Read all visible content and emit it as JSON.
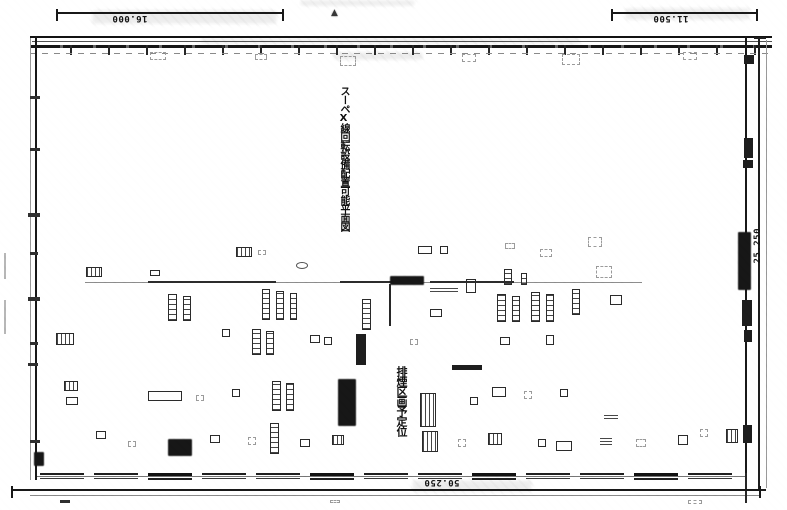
{
  "dimension_labels": {
    "top_left": "16.000",
    "top_right": "11.500",
    "bottom": "50.250",
    "right": "25.250"
  },
  "markers": {
    "section_triangle": "▲"
  },
  "vertical_texts": {
    "main": "スーペX線回転設備配置可能平面図",
    "lower": "排煙区画予定位"
  },
  "colors": {
    "paper": "#ffffff",
    "ink": "#1c1c1c",
    "ink_mid": "#444444",
    "ink_faint": "#999999",
    "smudge": "#d6d6d6"
  },
  "symbols": [
    {
      "x": 150,
      "y": 52,
      "w": 16,
      "h": 8,
      "k": "faint"
    },
    {
      "x": 255,
      "y": 54,
      "w": 12,
      "h": 6,
      "k": "faint"
    },
    {
      "x": 340,
      "y": 56,
      "w": 16,
      "h": 10,
      "k": "faint"
    },
    {
      "x": 462,
      "y": 54,
      "w": 14,
      "h": 8,
      "k": "faint"
    },
    {
      "x": 562,
      "y": 54,
      "w": 18,
      "h": 11,
      "k": "faint"
    },
    {
      "x": 683,
      "y": 52,
      "w": 14,
      "h": 8,
      "k": "faint"
    },
    {
      "x": 744,
      "y": 55,
      "w": 10,
      "h": 9,
      "k": "dark"
    },
    {
      "x": 30,
      "y": 96,
      "w": 10,
      "h": 3,
      "k": "tick"
    },
    {
      "x": 30,
      "y": 148,
      "w": 10,
      "h": 3,
      "k": "tick"
    },
    {
      "x": 28,
      "y": 213,
      "w": 12,
      "h": 4,
      "k": "tick"
    },
    {
      "x": 30,
      "y": 252,
      "w": 8,
      "h": 3,
      "k": "tick"
    },
    {
      "x": 28,
      "y": 297,
      "w": 12,
      "h": 4,
      "k": "tick"
    },
    {
      "x": 30,
      "y": 342,
      "w": 8,
      "h": 3,
      "k": "tick"
    },
    {
      "x": 28,
      "y": 363,
      "w": 10,
      "h": 3,
      "k": "tick"
    },
    {
      "x": 30,
      "y": 440,
      "w": 10,
      "h": 3,
      "k": "tick"
    },
    {
      "x": 34,
      "y": 452,
      "w": 10,
      "h": 14,
      "k": "dense"
    },
    {
      "x": 4,
      "y": 253,
      "w": 2,
      "h": 26,
      "k": "vfaint"
    },
    {
      "x": 4,
      "y": 300,
      "w": 2,
      "h": 34,
      "k": "vfaint"
    },
    {
      "x": 744,
      "y": 138,
      "w": 9,
      "h": 20,
      "k": "dark"
    },
    {
      "x": 743,
      "y": 160,
      "w": 10,
      "h": 8,
      "k": "dark"
    },
    {
      "x": 738,
      "y": 232,
      "w": 13,
      "h": 58,
      "k": "dense"
    },
    {
      "x": 742,
      "y": 300,
      "w": 10,
      "h": 26,
      "k": "dark"
    },
    {
      "x": 744,
      "y": 330,
      "w": 8,
      "h": 12,
      "k": "dark"
    },
    {
      "x": 743,
      "y": 425,
      "w": 9,
      "h": 18,
      "k": "dark"
    },
    {
      "x": 236,
      "y": 247,
      "w": 16,
      "h": 10,
      "k": "grid"
    },
    {
      "x": 258,
      "y": 250,
      "w": 8,
      "h": 5,
      "k": "faint"
    },
    {
      "x": 296,
      "y": 262,
      "w": 12,
      "h": 7,
      "k": "circ"
    },
    {
      "x": 418,
      "y": 246,
      "w": 14,
      "h": 8,
      "k": "rect"
    },
    {
      "x": 440,
      "y": 246,
      "w": 8,
      "h": 8,
      "k": "rect"
    },
    {
      "x": 505,
      "y": 243,
      "w": 10,
      "h": 6,
      "k": "faint"
    },
    {
      "x": 540,
      "y": 249,
      "w": 12,
      "h": 8,
      "k": "faint"
    },
    {
      "x": 588,
      "y": 237,
      "w": 14,
      "h": 10,
      "k": "faint"
    },
    {
      "x": 86,
      "y": 267,
      "w": 16,
      "h": 10,
      "k": "grid"
    },
    {
      "x": 150,
      "y": 270,
      "w": 10,
      "h": 6,
      "k": "rect"
    },
    {
      "x": 85,
      "y": 282,
      "w": 557,
      "h": 1,
      "k": "hfaint"
    },
    {
      "x": 148,
      "y": 281,
      "w": 128,
      "h": 2,
      "k": "hline"
    },
    {
      "x": 340,
      "y": 281,
      "w": 60,
      "h": 2,
      "k": "hline"
    },
    {
      "x": 430,
      "y": 281,
      "w": 84,
      "h": 2,
      "k": "hline"
    },
    {
      "x": 390,
      "y": 276,
      "w": 34,
      "h": 9,
      "k": "dense"
    },
    {
      "x": 430,
      "y": 286,
      "w": 28,
      "h": 6,
      "k": "lines"
    },
    {
      "x": 466,
      "y": 279,
      "w": 10,
      "h": 14,
      "k": "rect"
    },
    {
      "x": 504,
      "y": 269,
      "w": 8,
      "h": 16,
      "k": "tall"
    },
    {
      "x": 521,
      "y": 273,
      "w": 6,
      "h": 12,
      "k": "tall"
    },
    {
      "x": 596,
      "y": 266,
      "w": 16,
      "h": 12,
      "k": "faint"
    },
    {
      "x": 389,
      "y": 284,
      "w": 2,
      "h": 42,
      "k": "vline"
    },
    {
      "x": 168,
      "y": 294,
      "w": 9,
      "h": 27,
      "k": "tall"
    },
    {
      "x": 183,
      "y": 296,
      "w": 8,
      "h": 25,
      "k": "tall"
    },
    {
      "x": 262,
      "y": 289,
      "w": 8,
      "h": 31,
      "k": "tall"
    },
    {
      "x": 276,
      "y": 291,
      "w": 8,
      "h": 29,
      "k": "tall"
    },
    {
      "x": 290,
      "y": 293,
      "w": 7,
      "h": 27,
      "k": "tall"
    },
    {
      "x": 362,
      "y": 299,
      "w": 9,
      "h": 31,
      "k": "tall"
    },
    {
      "x": 430,
      "y": 309,
      "w": 12,
      "h": 8,
      "k": "rect"
    },
    {
      "x": 497,
      "y": 294,
      "w": 9,
      "h": 28,
      "k": "tall"
    },
    {
      "x": 512,
      "y": 296,
      "w": 8,
      "h": 26,
      "k": "tall"
    },
    {
      "x": 531,
      "y": 292,
      "w": 9,
      "h": 30,
      "k": "tall"
    },
    {
      "x": 546,
      "y": 294,
      "w": 8,
      "h": 28,
      "k": "tall"
    },
    {
      "x": 572,
      "y": 289,
      "w": 8,
      "h": 26,
      "k": "tall"
    },
    {
      "x": 610,
      "y": 295,
      "w": 12,
      "h": 10,
      "k": "rect"
    },
    {
      "x": 56,
      "y": 333,
      "w": 18,
      "h": 12,
      "k": "grid"
    },
    {
      "x": 222,
      "y": 329,
      "w": 8,
      "h": 8,
      "k": "rect"
    },
    {
      "x": 252,
      "y": 329,
      "w": 9,
      "h": 26,
      "k": "tall"
    },
    {
      "x": 266,
      "y": 331,
      "w": 8,
      "h": 24,
      "k": "tall"
    },
    {
      "x": 310,
      "y": 335,
      "w": 10,
      "h": 8,
      "k": "rect"
    },
    {
      "x": 324,
      "y": 337,
      "w": 8,
      "h": 8,
      "k": "rect"
    },
    {
      "x": 356,
      "y": 334,
      "w": 10,
      "h": 31,
      "k": "dark"
    },
    {
      "x": 410,
      "y": 339,
      "w": 8,
      "h": 6,
      "k": "faint"
    },
    {
      "x": 452,
      "y": 365,
      "w": 30,
      "h": 5,
      "k": "dark"
    },
    {
      "x": 500,
      "y": 337,
      "w": 10,
      "h": 8,
      "k": "rect"
    },
    {
      "x": 546,
      "y": 335,
      "w": 8,
      "h": 10,
      "k": "rect"
    },
    {
      "x": 64,
      "y": 381,
      "w": 14,
      "h": 10,
      "k": "grid"
    },
    {
      "x": 66,
      "y": 397,
      "w": 12,
      "h": 8,
      "k": "rect"
    },
    {
      "x": 148,
      "y": 391,
      "w": 34,
      "h": 10,
      "k": "rect"
    },
    {
      "x": 196,
      "y": 395,
      "w": 8,
      "h": 6,
      "k": "faint"
    },
    {
      "x": 232,
      "y": 389,
      "w": 8,
      "h": 8,
      "k": "rect"
    },
    {
      "x": 272,
      "y": 381,
      "w": 9,
      "h": 30,
      "k": "tall"
    },
    {
      "x": 286,
      "y": 383,
      "w": 8,
      "h": 28,
      "k": "tall"
    },
    {
      "x": 338,
      "y": 379,
      "w": 18,
      "h": 47,
      "k": "dense"
    },
    {
      "x": 420,
      "y": 393,
      "w": 16,
      "h": 34,
      "k": "grid"
    },
    {
      "x": 470,
      "y": 397,
      "w": 8,
      "h": 8,
      "k": "rect"
    },
    {
      "x": 492,
      "y": 387,
      "w": 14,
      "h": 10,
      "k": "rect"
    },
    {
      "x": 524,
      "y": 391,
      "w": 8,
      "h": 8,
      "k": "faint"
    },
    {
      "x": 560,
      "y": 389,
      "w": 8,
      "h": 8,
      "k": "rect"
    },
    {
      "x": 604,
      "y": 413,
      "w": 14,
      "h": 6,
      "k": "lines"
    },
    {
      "x": 96,
      "y": 431,
      "w": 10,
      "h": 8,
      "k": "rect"
    },
    {
      "x": 128,
      "y": 441,
      "w": 8,
      "h": 6,
      "k": "faint"
    },
    {
      "x": 168,
      "y": 439,
      "w": 24,
      "h": 17,
      "k": "dense"
    },
    {
      "x": 210,
      "y": 435,
      "w": 10,
      "h": 8,
      "k": "rect"
    },
    {
      "x": 248,
      "y": 437,
      "w": 8,
      "h": 8,
      "k": "faint"
    },
    {
      "x": 270,
      "y": 423,
      "w": 9,
      "h": 31,
      "k": "tall"
    },
    {
      "x": 300,
      "y": 439,
      "w": 10,
      "h": 8,
      "k": "rect"
    },
    {
      "x": 332,
      "y": 435,
      "w": 12,
      "h": 10,
      "k": "grid"
    },
    {
      "x": 422,
      "y": 431,
      "w": 16,
      "h": 21,
      "k": "grid"
    },
    {
      "x": 458,
      "y": 439,
      "w": 8,
      "h": 8,
      "k": "faint"
    },
    {
      "x": 488,
      "y": 433,
      "w": 14,
      "h": 12,
      "k": "grid"
    },
    {
      "x": 538,
      "y": 439,
      "w": 8,
      "h": 8,
      "k": "rect"
    },
    {
      "x": 556,
      "y": 441,
      "w": 16,
      "h": 10,
      "k": "rect"
    },
    {
      "x": 600,
      "y": 437,
      "w": 12,
      "h": 8,
      "k": "lines"
    },
    {
      "x": 636,
      "y": 439,
      "w": 10,
      "h": 8,
      "k": "faint"
    },
    {
      "x": 678,
      "y": 435,
      "w": 10,
      "h": 10,
      "k": "rect"
    },
    {
      "x": 700,
      "y": 429,
      "w": 8,
      "h": 8,
      "k": "faint"
    },
    {
      "x": 726,
      "y": 429,
      "w": 12,
      "h": 14,
      "k": "grid"
    },
    {
      "x": 745,
      "y": 473,
      "w": 2,
      "h": 30,
      "k": "vline"
    },
    {
      "x": 60,
      "y": 500,
      "w": 10,
      "h": 3,
      "k": "tick"
    },
    {
      "x": 688,
      "y": 500,
      "w": 14,
      "h": 4,
      "k": "faint"
    },
    {
      "x": 330,
      "y": 500,
      "w": 10,
      "h": 3,
      "k": "faint"
    }
  ],
  "bottom_wall_segments": [
    {
      "x": 40,
      "y": 473,
      "w": 44,
      "h": 6,
      "k": "win"
    },
    {
      "x": 94,
      "y": 473,
      "w": 44,
      "h": 6,
      "k": "win"
    },
    {
      "x": 148,
      "y": 473,
      "w": 44,
      "h": 7,
      "k": "win2"
    },
    {
      "x": 202,
      "y": 473,
      "w": 44,
      "h": 6,
      "k": "win"
    },
    {
      "x": 256,
      "y": 473,
      "w": 44,
      "h": 6,
      "k": "win"
    },
    {
      "x": 310,
      "y": 473,
      "w": 44,
      "h": 7,
      "k": "win2"
    },
    {
      "x": 364,
      "y": 473,
      "w": 44,
      "h": 6,
      "k": "win"
    },
    {
      "x": 418,
      "y": 473,
      "w": 44,
      "h": 6,
      "k": "win"
    },
    {
      "x": 472,
      "y": 473,
      "w": 44,
      "h": 7,
      "k": "win2"
    },
    {
      "x": 526,
      "y": 473,
      "w": 44,
      "h": 6,
      "k": "win"
    },
    {
      "x": 580,
      "y": 473,
      "w": 44,
      "h": 6,
      "k": "win"
    },
    {
      "x": 634,
      "y": 473,
      "w": 44,
      "h": 7,
      "k": "win2"
    },
    {
      "x": 688,
      "y": 473,
      "w": 44,
      "h": 6,
      "k": "win"
    }
  ]
}
